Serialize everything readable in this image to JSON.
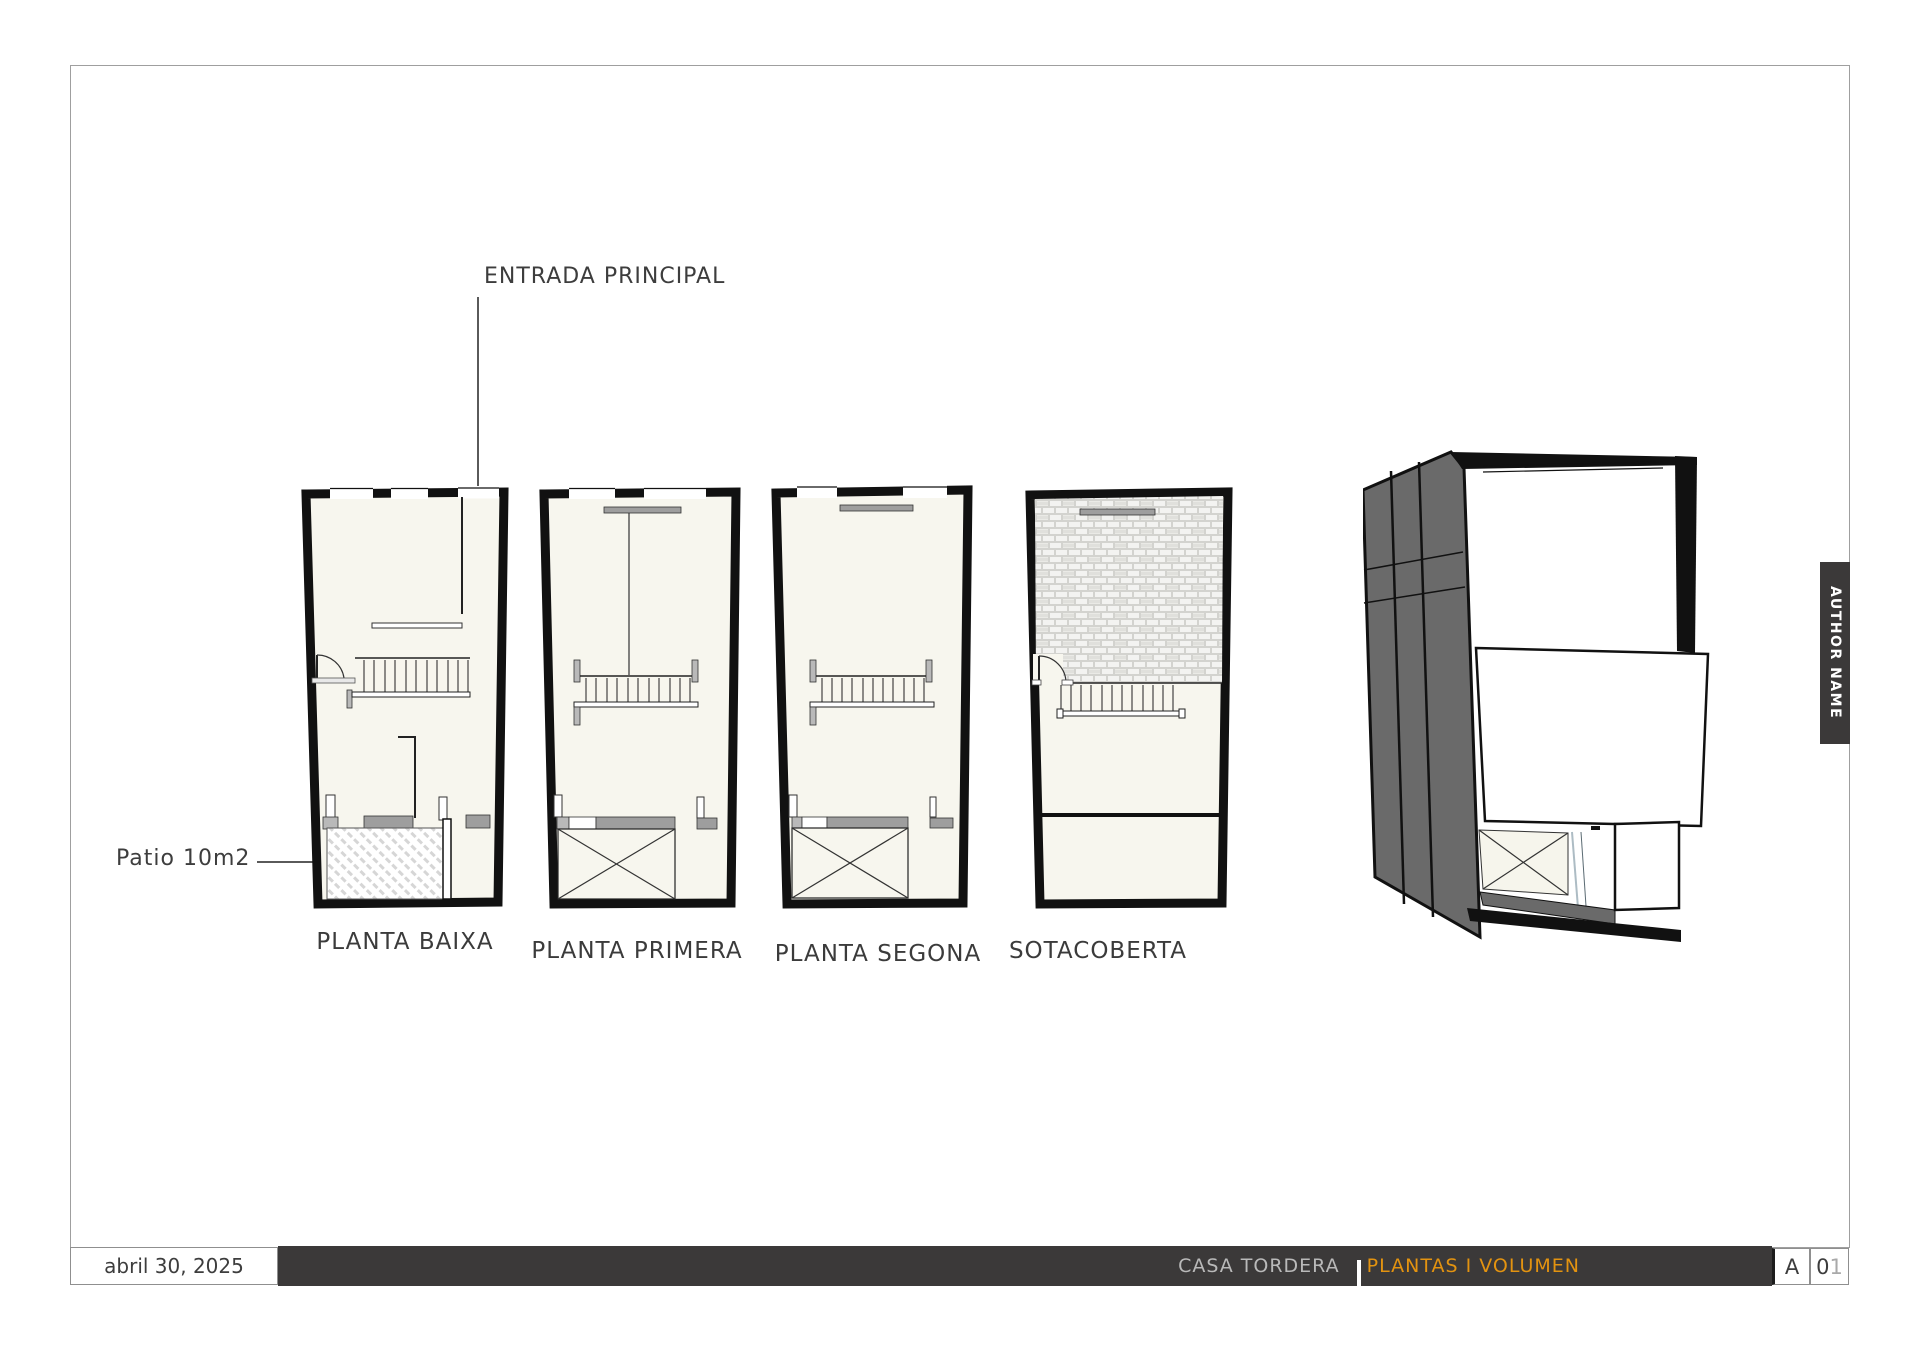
{
  "annotations": {
    "entrance": {
      "label": "ENTRADA PRINCIPAL"
    },
    "patio": {
      "label": "Patio 10m2"
    }
  },
  "plans": [
    {
      "label": "PLANTA BAIXA"
    },
    {
      "label": "PLANTA PRIMERA"
    },
    {
      "label": "PLANTA SEGONA"
    },
    {
      "label": "SOTACOBERTA"
    }
  ],
  "author_tab": {
    "label": "AUTHOR NAME"
  },
  "title_block": {
    "date": "abril 30, 2025",
    "project": "CASA TORDERA ",
    "cursor": "|",
    "sheet_title": "PLANTAS I VOLUMEN",
    "series": "A",
    "number_primary": "0",
    "number_secondary": "1"
  },
  "colors": {
    "titlebar_bg": "#3b3939",
    "project_text": "#b9b9b9",
    "sheet_title_accent": "#e39310",
    "annotation_text": "#3d3d3d",
    "wall_ink": "#111111",
    "floor_fill": "#f7f6ee",
    "volume_gray": "#6a6a6a"
  }
}
